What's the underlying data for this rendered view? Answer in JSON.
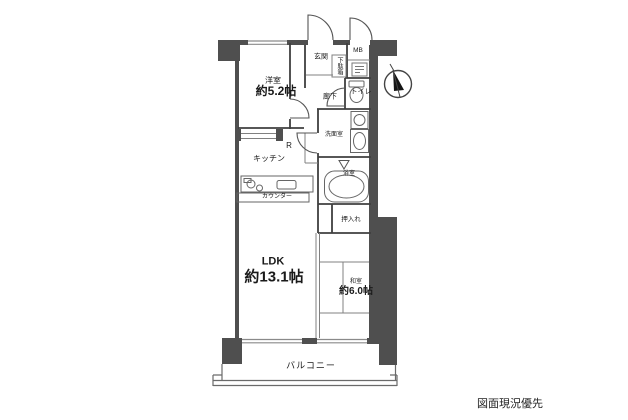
{
  "drawing_note": "図面現況優先",
  "rooms": {
    "bedroom": {
      "name": "洋室",
      "size": "約5.2帖"
    },
    "ldk": {
      "name": "LDK",
      "size": "約13.1帖"
    },
    "japanese_room": {
      "name": "和室",
      "size": "約6.0帖"
    },
    "entrance": {
      "label": "玄関"
    },
    "shoe_cabinet": {
      "label": "下駄箱"
    },
    "meter_box": {
      "label": "MB"
    },
    "toilet": {
      "label": "トイレ"
    },
    "hallway": {
      "label": "廊下"
    },
    "washroom": {
      "label": "洗面室"
    },
    "bathroom": {
      "label": "浴室"
    },
    "refrigerator_space": {
      "label": "R"
    },
    "kitchen": {
      "label": "キッチン"
    },
    "counter": {
      "label": "カウンター"
    },
    "closet": {
      "label": "押入れ"
    },
    "balcony": {
      "label": "バルコニー"
    }
  },
  "icons": {
    "compass": "north-arrow",
    "fixtures": [
      "toilet-icon",
      "bathtub-icon",
      "washbasin-icon",
      "washing-machine-icon",
      "stove-burners-icon",
      "sink-icon",
      "meter-box-icon"
    ]
  },
  "colors": {
    "wall_fill": "#4f4f4f",
    "wall_line": "#3f3f3f",
    "thin_line": "#808080",
    "text": "#1a1a1a",
    "background": "#ffffff"
  }
}
